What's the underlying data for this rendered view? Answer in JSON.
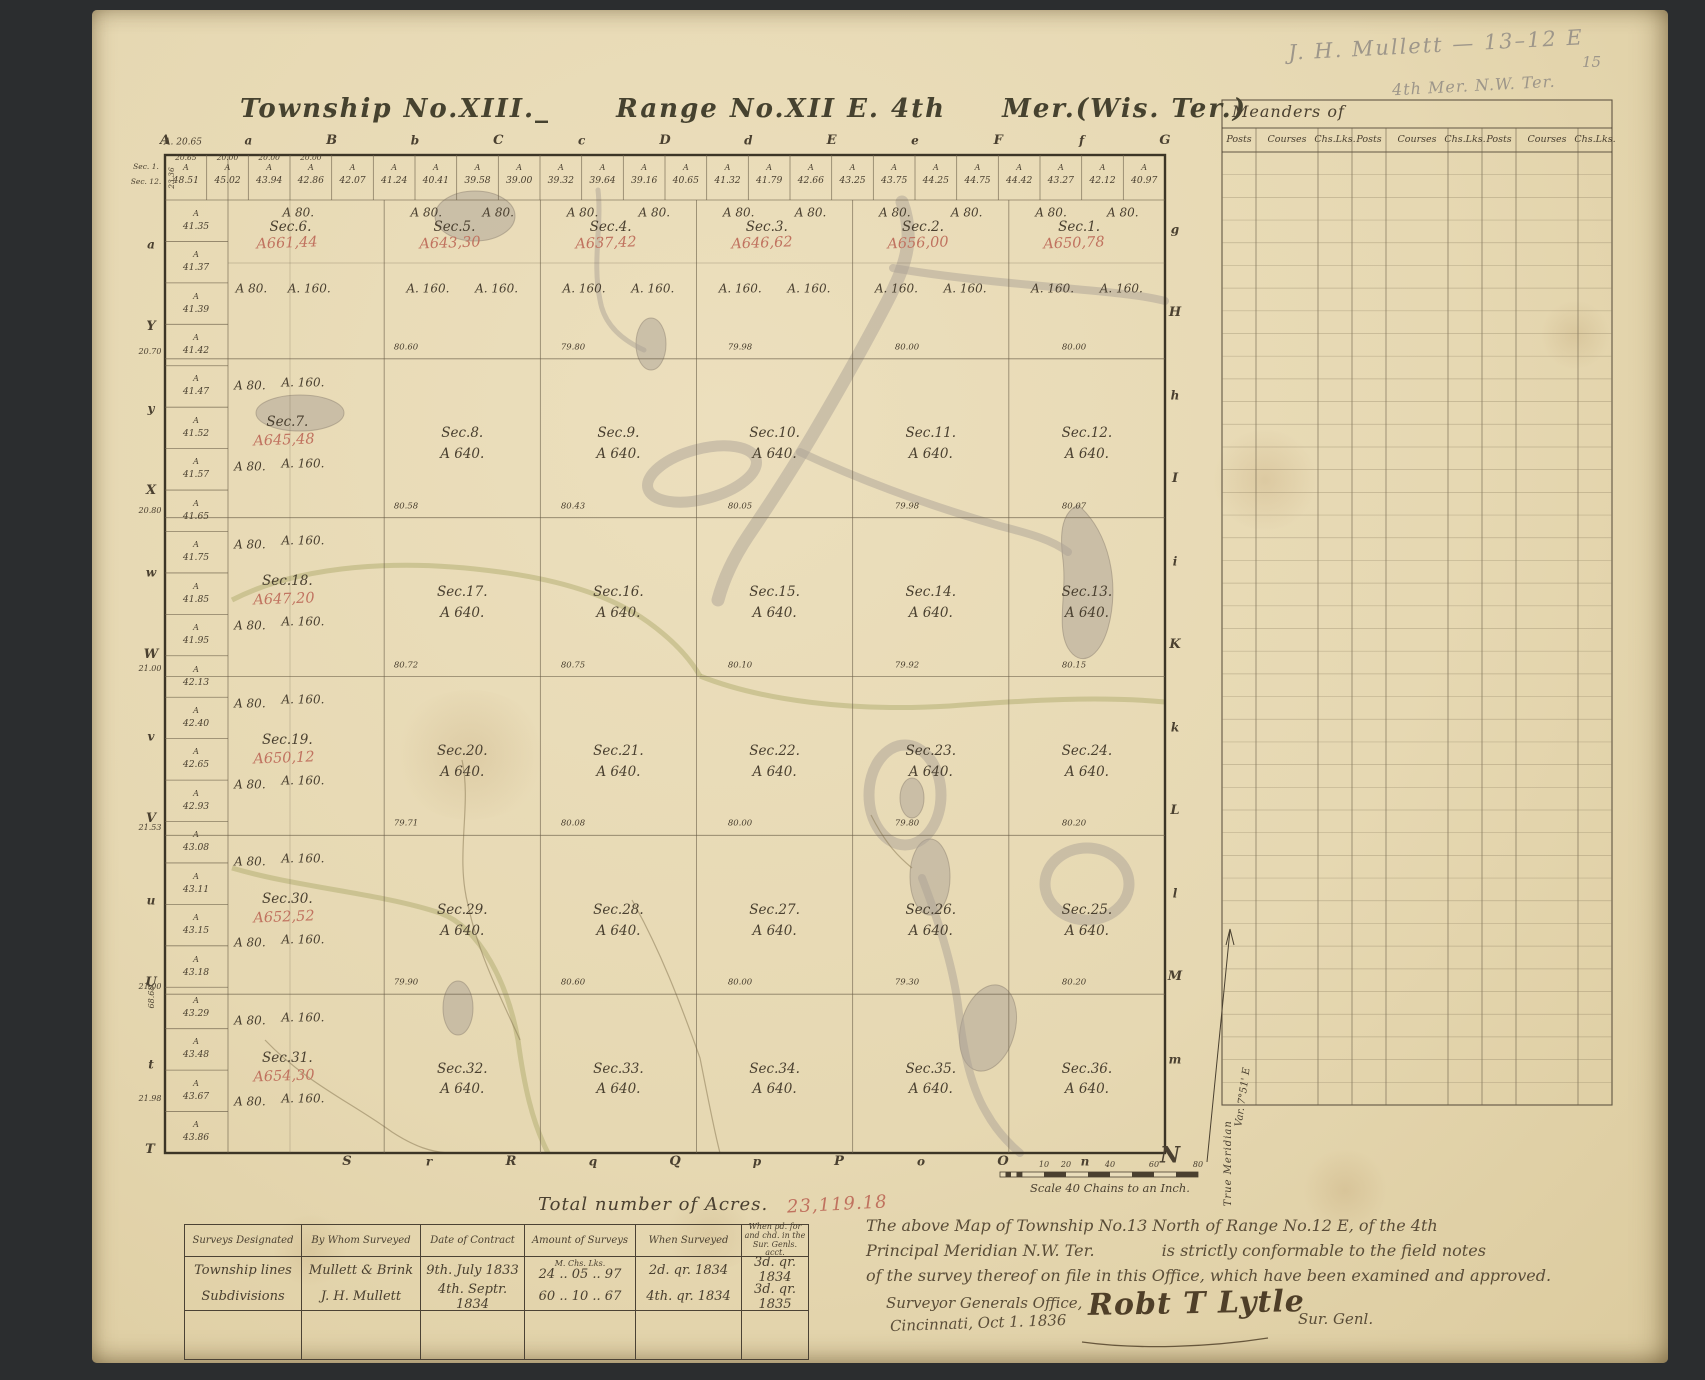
{
  "page": {
    "pencil_note_line1": "J. H. Mullett — 13–12 E",
    "pencil_note_line2": "4th Mer. N.W. Ter.",
    "page_number": "15"
  },
  "title": {
    "part1": "Township No.XIII._",
    "part2": "Range No.XII E. 4th",
    "part3": "Mer.(Wis. Ter.)"
  },
  "meanders": {
    "title": "Meanders of",
    "columns": [
      "Posts",
      "Courses",
      "Chs.Lks.",
      "Posts",
      "Courses",
      "Chs.Lks.",
      "Posts",
      "Courses",
      "Chs.Lks."
    ]
  },
  "map": {
    "corner_note": "A. 20.65",
    "corner_rotated": "23.36",
    "left_lower_rotated": "68.68",
    "outside_left_top": [
      "Sec. 1.",
      "Sec. 12."
    ],
    "top_letters": [
      "A",
      "a",
      "B",
      "b",
      "C",
      "c",
      "D",
      "d",
      "E",
      "e",
      "F",
      "f",
      "G"
    ],
    "left_letters": [
      "a",
      "Y",
      "y",
      "X",
      "w",
      "W",
      "v",
      "V",
      "u",
      "U",
      "t"
    ],
    "right_letters": [
      "g",
      "H",
      "h",
      "I",
      "i",
      "K",
      "k",
      "L",
      "l",
      "M",
      "m"
    ],
    "bottom_letters": [
      "S",
      "r",
      "R",
      "q",
      "Q",
      "p",
      "P",
      "o",
      "O",
      "n"
    ],
    "corner_bottom_left": "T",
    "compass_north": "N",
    "top_strip_sub_values": [
      "20.65",
      "20.00",
      "20.00",
      "20.00"
    ],
    "top_strip_values": [
      "48.51",
      "45.02",
      "43.94",
      "42.86",
      "42.07",
      "41.24",
      "40.41",
      "39.58",
      "39.00",
      "39.32",
      "39.64",
      "39.16",
      "40.65",
      "41.32",
      "41.79",
      "42.66",
      "43.25",
      "43.75",
      "44.25",
      "44.75",
      "44.42",
      "43.27",
      "42.12",
      "40.97"
    ],
    "left_strip_values": [
      "41.35",
      "41.37",
      "41.39",
      "41.42",
      "41.47",
      "41.52",
      "41.57",
      "41.65",
      "41.75",
      "41.85",
      "41.95",
      "42.13",
      "42.40",
      "42.65",
      "42.93",
      "43.08",
      "43.11",
      "43.15",
      "43.18",
      "43.29",
      "43.48",
      "43.67",
      "43.86"
    ],
    "left_margin_values": [
      "20.70",
      "20.80",
      "21.00",
      "21.53",
      "21.00",
      "21.98"
    ],
    "line_values": [
      [
        "80.60",
        "79.80",
        "79.98",
        "80.00",
        "80.00"
      ],
      [
        "80.58",
        "80.43",
        "80.05",
        "79.98",
        "80.07"
      ],
      [
        "80.72",
        "80.75",
        "80.10",
        "79.92",
        "80.15"
      ],
      [
        "79.71",
        "80.08",
        "80.00",
        "79.80",
        "80.20"
      ],
      [
        "79.90",
        "80.60",
        "80.00",
        "79.30",
        "80.20"
      ]
    ],
    "lot_labels": {
      "a80": "A 80.",
      "a160": "A. 160."
    },
    "sections": [
      {
        "label": "Sec.6.",
        "red": "A661,44",
        "tier": "nw"
      },
      {
        "label": "Sec.5.",
        "red": "A643,30",
        "tier": "n"
      },
      {
        "label": "Sec.4.",
        "red": "A637,42",
        "tier": "n"
      },
      {
        "label": "Sec.3.",
        "red": "A646,62",
        "tier": "n"
      },
      {
        "label": "Sec.2.",
        "red": "A656,00",
        "tier": "n"
      },
      {
        "label": "Sec.1.",
        "red": "A650,78",
        "tier": "n"
      },
      {
        "label": "Sec.7.",
        "red": "A645,48",
        "tier": "w"
      },
      {
        "label": "Sec.8.",
        "acres": "A 640.",
        "tier": "i"
      },
      {
        "label": "Sec.9.",
        "acres": "A 640.",
        "tier": "i"
      },
      {
        "label": "Sec.10.",
        "acres": "A 640.",
        "tier": "i"
      },
      {
        "label": "Sec.11.",
        "acres": "A 640.",
        "tier": "i"
      },
      {
        "label": "Sec.12.",
        "acres": "A 640.",
        "tier": "i"
      },
      {
        "label": "Sec.18.",
        "red": "A647,20",
        "tier": "w"
      },
      {
        "label": "Sec.17.",
        "acres": "A 640.",
        "tier": "i"
      },
      {
        "label": "Sec.16.",
        "acres": "A 640.",
        "tier": "i"
      },
      {
        "label": "Sec.15.",
        "acres": "A 640.",
        "tier": "i"
      },
      {
        "label": "Sec.14.",
        "acres": "A 640.",
        "tier": "i"
      },
      {
        "label": "Sec.13.",
        "acres": "A 640.",
        "tier": "i"
      },
      {
        "label": "Sec.19.",
        "red": "A650,12",
        "tier": "w"
      },
      {
        "label": "Sec.20.",
        "acres": "A 640.",
        "tier": "i"
      },
      {
        "label": "Sec.21.",
        "acres": "A 640.",
        "tier": "i"
      },
      {
        "label": "Sec.22.",
        "acres": "A 640.",
        "tier": "i"
      },
      {
        "label": "Sec.23.",
        "acres": "A 640.",
        "tier": "i"
      },
      {
        "label": "Sec.24.",
        "acres": "A 640.",
        "tier": "i"
      },
      {
        "label": "Sec.30.",
        "red": "A652,52",
        "tier": "w"
      },
      {
        "label": "Sec.29.",
        "acres": "A 640.",
        "tier": "i"
      },
      {
        "label": "Sec.28.",
        "acres": "A 640.",
        "tier": "i"
      },
      {
        "label": "Sec.27.",
        "acres": "A 640.",
        "tier": "i"
      },
      {
        "label": "Sec.26.",
        "acres": "A 640.",
        "tier": "i"
      },
      {
        "label": "Sec.25.",
        "acres": "A 640.",
        "tier": "i"
      },
      {
        "label": "Sec.31.",
        "red": "A654,30",
        "tier": "w"
      },
      {
        "label": "Sec.32.",
        "acres": "A 640.",
        "tier": "i"
      },
      {
        "label": "Sec.33.",
        "acres": "A 640.",
        "tier": "i"
      },
      {
        "label": "Sec.34.",
        "acres": "A 640.",
        "tier": "i"
      },
      {
        "label": "Sec.35.",
        "acres": "A 640.",
        "tier": "i"
      },
      {
        "label": "Sec.36.",
        "acres": "A 640.",
        "tier": "i"
      }
    ],
    "scale": {
      "ticks": [
        "10",
        "20",
        "40",
        "60",
        "80"
      ],
      "caption": "Scale 40 Chains to an Inch."
    },
    "compass": {
      "meridian_label": "True Meridian",
      "variation": "Var. 7°51' E"
    }
  },
  "totals": {
    "label": "Total number of Acres.",
    "value": "23,119.18"
  },
  "surveys": {
    "headers": [
      "Surveys Designated",
      "By Whom Surveyed",
      "Date of Contract",
      "Amount of Surveys",
      "When Surveyed",
      "When pd. for and chd. in the Sur. Genls. acct."
    ],
    "amount_units": "M.   Chs.   Lks.",
    "rows": [
      {
        "designated": "Township lines",
        "by": "Mullett & Brink",
        "date": "9th. July 1833",
        "amount": "24 .. 05 .. 97",
        "surveyed": "2d. qr. 1834",
        "paid": "3d. qr. 1834"
      },
      {
        "designated": "Subdivisions",
        "by": "J. H. Mullett",
        "date": "4th. Septr. 1834",
        "amount": "60 .. 10 .. 67",
        "surveyed": "4th. qr. 1834",
        "paid": "3d. qr. 1835"
      }
    ]
  },
  "certification": {
    "line1": "The above Map of Township No.13 North of Range No.12 E, of the 4th",
    "line2a": "Principal Meridian N.W. Ter.",
    "line2b": "is strictly conformable to the field notes",
    "line3": "of the survey thereof on file in this Office, which have been examined and approved.",
    "office1": "Surveyor Generals Office,",
    "office2": "Cincinnati, Oct 1. 1836",
    "signature": "Robt T Lytle",
    "sig_title": "Sur. Genl."
  }
}
